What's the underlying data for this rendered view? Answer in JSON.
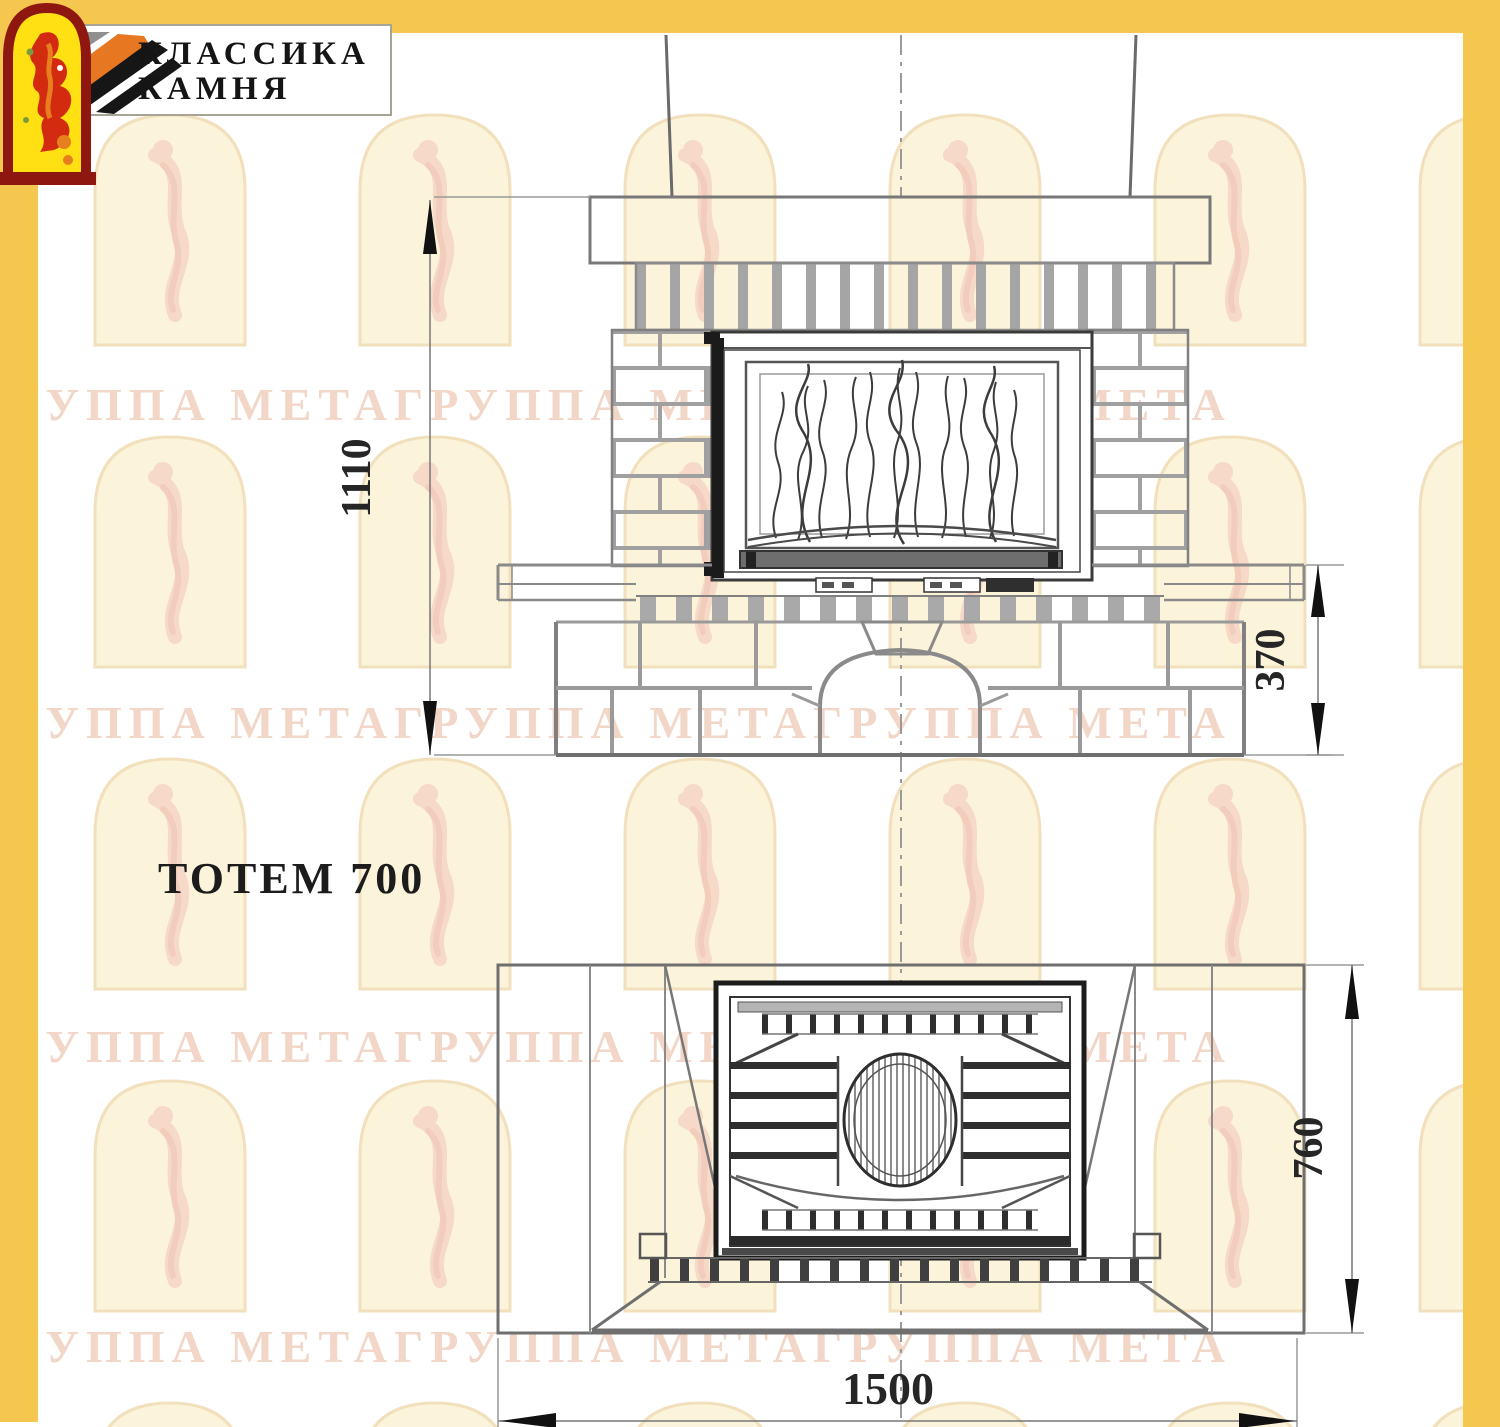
{
  "logo": {
    "line1": "КЛАССИКА",
    "line2": "КАМНЯ"
  },
  "title": "ТОТЕМ 700",
  "front_view": {
    "height_dim": "1110",
    "plinth_height_dim": "370"
  },
  "plan_view": {
    "depth_dim": "760",
    "width_dim": "1500"
  },
  "watermark": {
    "text": "ГРУППА МЕТАГРУППА МЕТАГРУППА МЕТА"
  },
  "colors": {
    "border_yellow": "#F5C74E",
    "logo_orange": "#E87722",
    "logo_gray": "#8F8F8F",
    "logo_black": "#161616",
    "emblem_border_red": "#8E1810",
    "emblem_yellow": "#FFE012",
    "emblem_figure_red": "#D22B10",
    "watermark_arch": "#F2E0BD",
    "watermark_text": "#F2D7C8",
    "drawing_line_gray": "#7D7D7D"
  }
}
